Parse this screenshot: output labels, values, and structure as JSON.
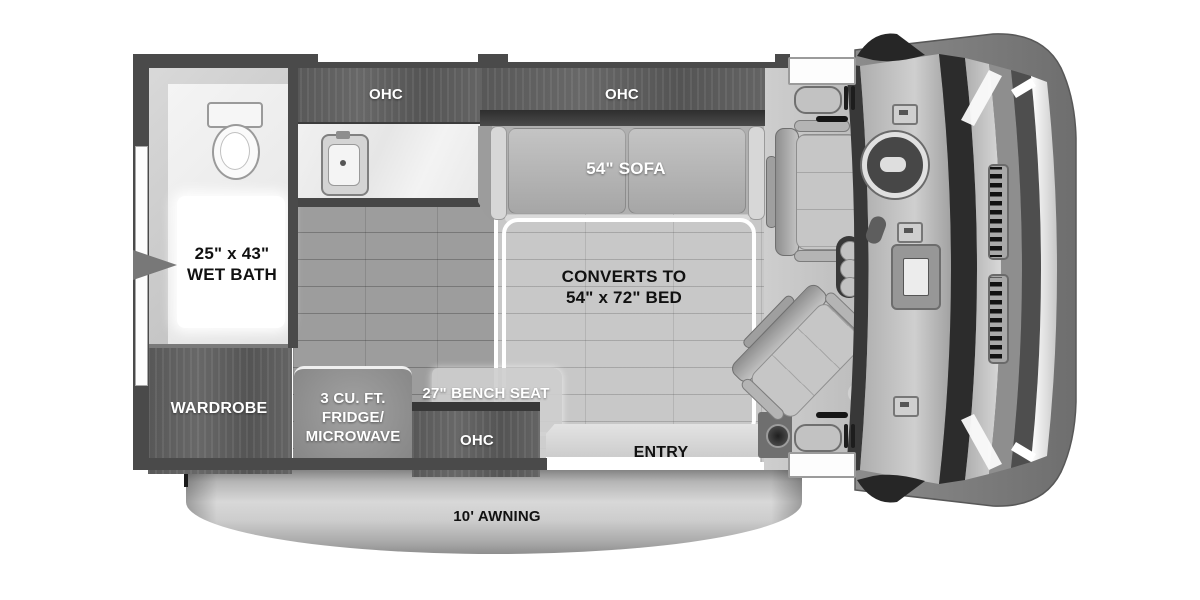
{
  "title": "Camper van floor plan",
  "colors": {
    "wall": "#4a4a4a",
    "dark_wood": "#5d5d5d",
    "floor_dark": "#9d9d9d",
    "floor_light": "#c8c8c8",
    "awning_silver": "#c6c6c6",
    "label_on_dark": "#ffffff",
    "label_on_light": "#111111"
  },
  "labels": {
    "ohc_kitchen": "OHC",
    "ohc_sofa": "OHC",
    "sofa": "54\" SOFA",
    "bed_line1": "CONVERTS TO",
    "bed_line2": "54\" x 72\" BED",
    "wet_bath_line1": "25\" x 43\"",
    "wet_bath_line2": "WET BATH",
    "wardrobe": "WARDROBE",
    "fridge_line1": "3 CU. FT.",
    "fridge_line2": "FRIDGE/",
    "fridge_line3": "MICROWAVE",
    "bench_seat": "27\" BENCH SEAT",
    "ohc_bench": "OHC",
    "entry": "ENTRY",
    "awning": "10' AWNING"
  }
}
